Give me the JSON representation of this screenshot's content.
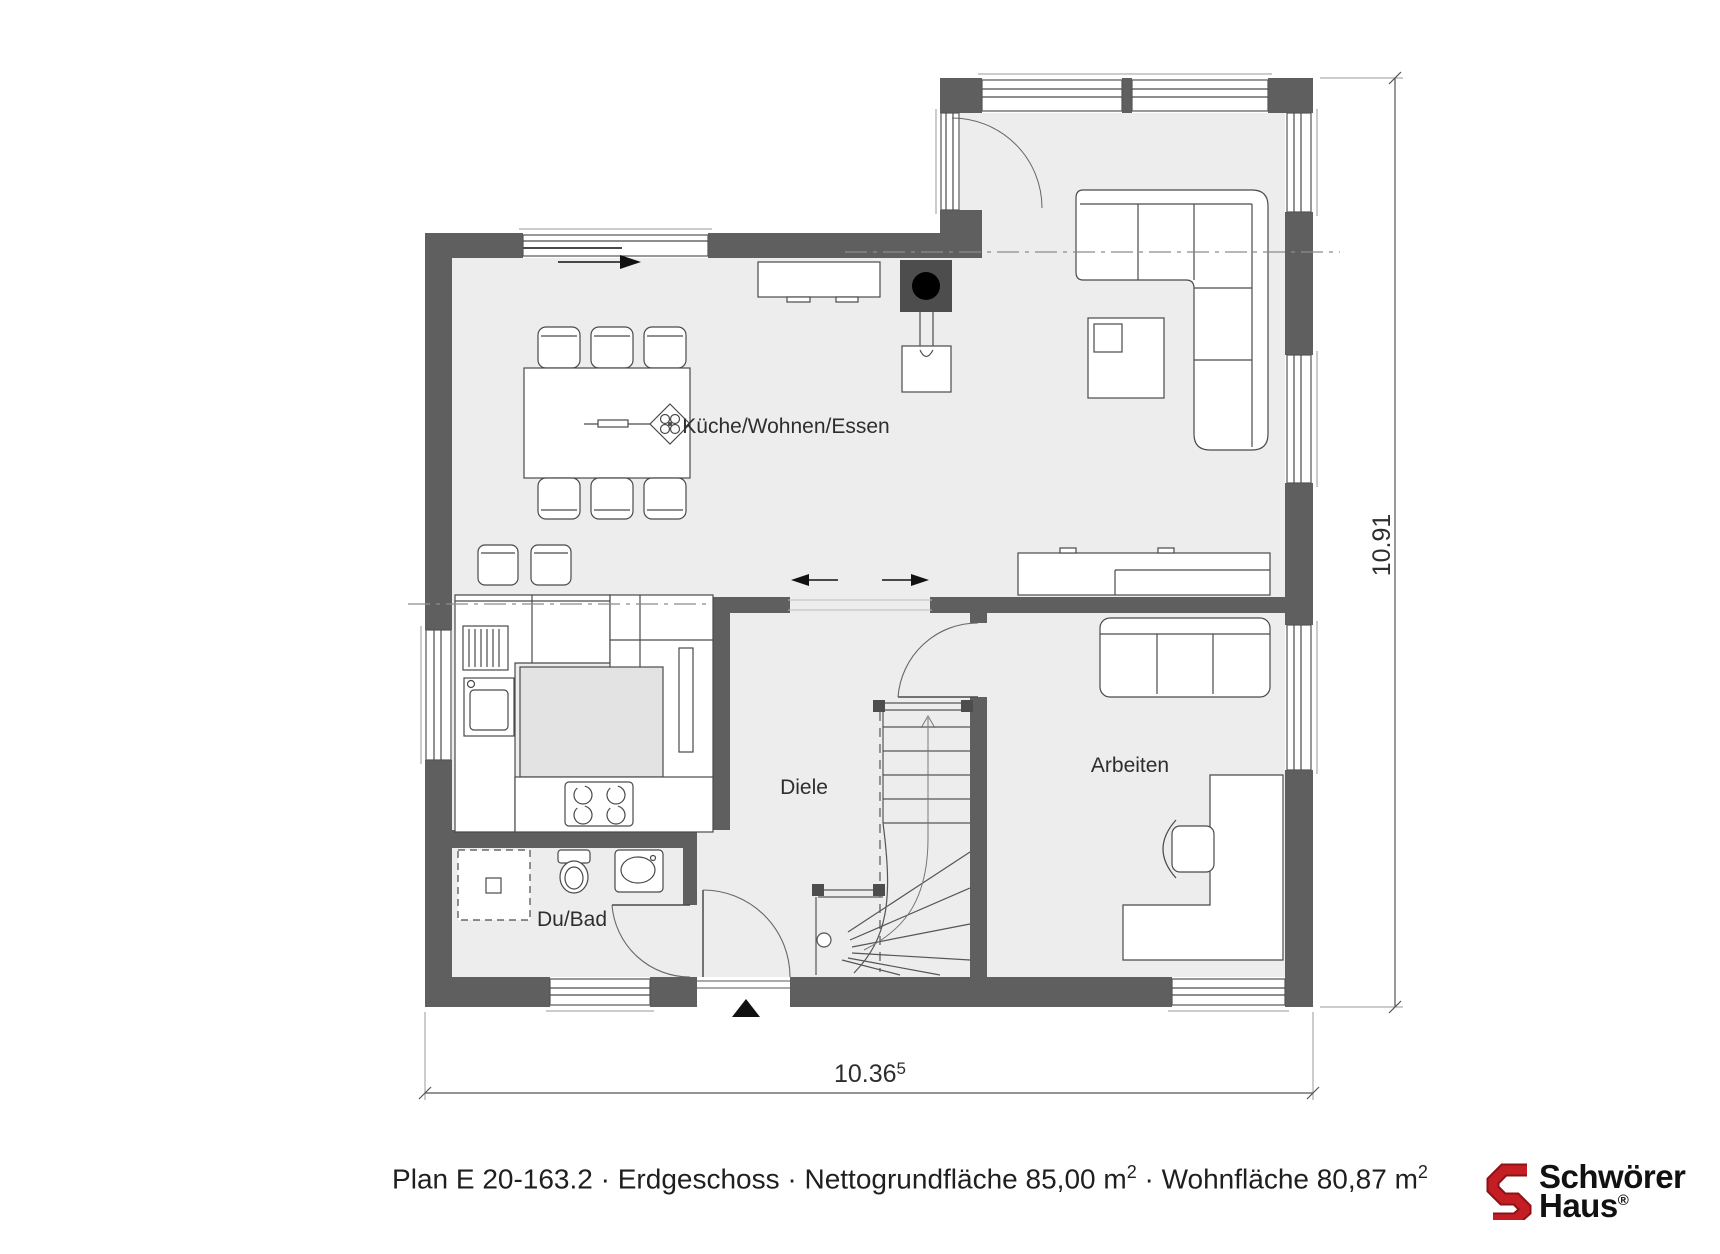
{
  "rooms": {
    "kueche": {
      "label": "Küche/Wohnen/Essen"
    },
    "diele": {
      "label": "Diele"
    },
    "arbeiten": {
      "label": "Arbeiten"
    },
    "dubad": {
      "label": "Du/Bad"
    }
  },
  "dimensions": {
    "width": {
      "main": "10.36",
      "sup": "5"
    },
    "height": {
      "main": "10.91"
    }
  },
  "caption": {
    "part1": "Plan E 20-163.2 · Erdgeschoss · Nettogrundfläche 85,00 m",
    "sup1": "2",
    "part2": " · Wohnfläche 80,87 m",
    "sup2": "2"
  },
  "logo": {
    "line1": "Schwörer",
    "line2": "Haus",
    "reg": "®"
  },
  "colors": {
    "wall": "#5f5f5f",
    "floor": "#ededed",
    "island_fill": "#e3e3e3",
    "line": "#4a4a4a",
    "brand_red": "#c41e24",
    "brand_red_dark": "#8d1216"
  }
}
